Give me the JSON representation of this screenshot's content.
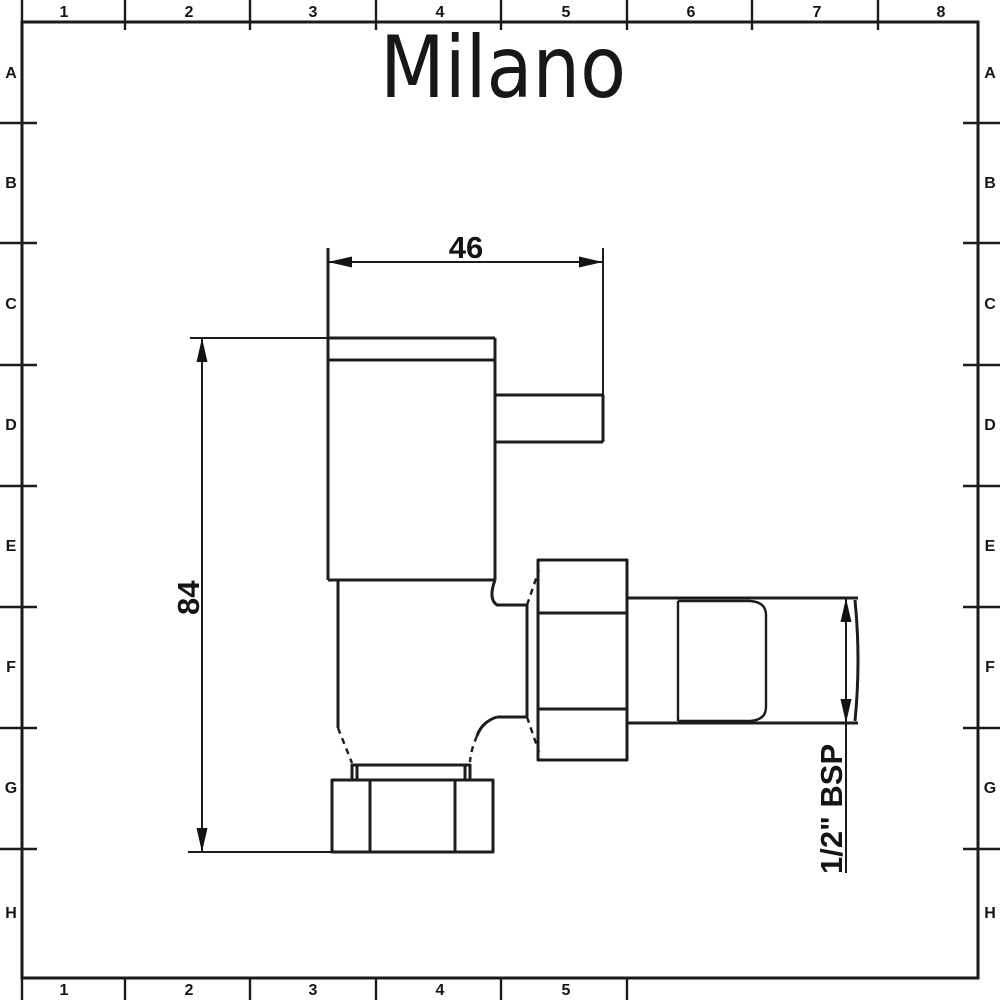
{
  "sheet": {
    "background": "#ffffff",
    "line_color": "#1c1c1c"
  },
  "logo": {
    "text": "Milano"
  },
  "grid": {
    "top_numbers": [
      "1",
      "2",
      "3",
      "4",
      "5",
      "6",
      "7",
      "8"
    ],
    "bottom_numbers": [
      "1",
      "2",
      "3",
      "4",
      "5"
    ],
    "left_letters": [
      "A",
      "B",
      "C",
      "D",
      "E",
      "F",
      "G",
      "H"
    ],
    "right_letters": [
      "A",
      "B",
      "C",
      "D",
      "E",
      "F",
      "G",
      "H"
    ]
  },
  "dimensions": {
    "valve_width": "46",
    "valve_height": "84",
    "thread_size": "1/2\" BSP"
  }
}
